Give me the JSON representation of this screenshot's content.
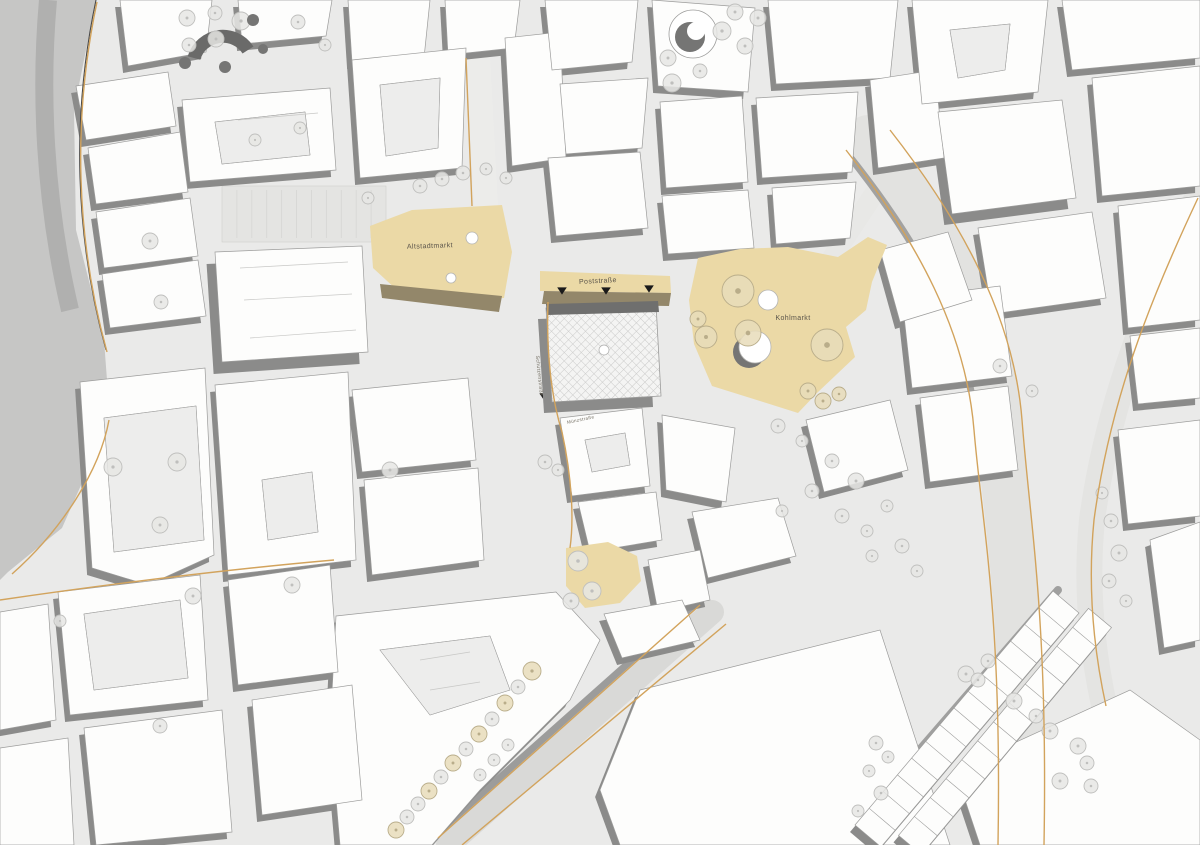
{
  "map": {
    "palette": {
      "street_bg": "#eaeae9",
      "road_band": "#c6c6c5",
      "road_band_inner": "#b0b0af",
      "building_fill": "#fdfdfc",
      "building_stroke": "#9c9c9b",
      "courtyard": "#ededec",
      "shadow": "#8b8b8a",
      "plaza_fill": "#ebd9a6",
      "plaza_band": "#93876a",
      "curb": "#d2a35c",
      "edge_dark": "#4a4a4a",
      "tree_light_fill": "#e6e6e4",
      "tree_light_stroke": "#bfbfbd",
      "tree_beige_fill": "#e8dcba",
      "tree_beige_stroke": "#b9ad8a",
      "tree_dark": "#757574",
      "hatch_bg": "#f4f4f3",
      "hatch_line": "#c9c9c8",
      "hatch_band": "#6f6f6e",
      "arrow": "#1a1a1a",
      "label": "#5a544a",
      "street_label": "#6f6a5e"
    },
    "labels": [
      {
        "text": "Altstadtmarkt",
        "x": 430,
        "y": 248,
        "size": 7,
        "rot": -2,
        "kind": "plaza"
      },
      {
        "text": "Poststraße",
        "x": 598,
        "y": 283,
        "size": 7,
        "rot": -3,
        "kind": "plaza"
      },
      {
        "text": "Kohlmarkt",
        "x": 793,
        "y": 320,
        "size": 7,
        "rot": 0,
        "kind": "plaza"
      },
      {
        "text": "Schützenstraße",
        "x": 538,
        "y": 376,
        "size": 5,
        "rot": 84,
        "kind": "street"
      },
      {
        "text": "Münzstraße",
        "x": 581,
        "y": 421,
        "size": 4.5,
        "rot": -12,
        "kind": "street"
      }
    ],
    "band": {
      "outline": "0,0 96,0 74,110 76,230 104,340 110,420 62,528 8,572 0,580",
      "inner": "M48,0 C40,90 44,200 70,310"
    },
    "roads": [
      {
        "d": "M486,206 L478,56",
        "c": "#ececea",
        "w": 24
      },
      {
        "d": "M832,258 L908,142",
        "c": "#e8e8e6",
        "w": 20
      },
      {
        "d": "M868,138 C940,230 990,320 998,420 C1006,520 1026,610 1022,845",
        "c": "#e2e2e0",
        "w": 46
      },
      {
        "d": "M846,152 C920,244 968,330 976,428",
        "c": "#a2a2a1",
        "w": 7
      },
      {
        "d": "M1198,196 C1150,300 1108,400 1092,520 C1086,580 1090,640 1104,705",
        "c": "#e4e4e2",
        "w": 26
      },
      {
        "d": "M712,612 L448,845",
        "c": "#d9d9d7",
        "w": 24
      },
      {
        "d": "M697,602 L434,836",
        "c": "#9c9c9b",
        "w": 7
      },
      {
        "d": "M850,830 L1058,590",
        "c": "#a0a09f",
        "w": 8
      }
    ],
    "curbs": [
      {
        "d": "M96,0 C71,118 75,238 106,350",
        "dark": true
      },
      {
        "d": "M97,2 C72,120 76,240 107,352"
      },
      {
        "d": "M109,420 C100,470 62,530 12,574"
      },
      {
        "d": "M700,605 L438,838"
      },
      {
        "d": "M726,624 L462,845"
      },
      {
        "d": "M846,150 C918,242 966,332 974,430 C982,525 1002,612 998,845"
      },
      {
        "d": "M890,130 C962,222 1014,318 1022,420 C1030,525 1048,615 1044,845"
      },
      {
        "d": "M1198,198 C1150,300 1110,400 1094,520 C1088,580 1092,642 1106,706"
      },
      {
        "d": "M548,302 C546,355 552,400 562,432 C572,478 574,520 570,548"
      },
      {
        "d": "M472,206 L466,58"
      },
      {
        "d": "M0,600 C110,584 220,570 334,560"
      }
    ],
    "parking": {
      "x": 222,
      "y": 186,
      "w": 164,
      "h": 56,
      "n": 11
    },
    "blocks": [
      {
        "pts": "120,0 212,0 206,52 128,66"
      },
      {
        "pts": "238,0 332,0 326,36 242,44"
      },
      {
        "pts": "348,0 430,0 424,58 352,62"
      },
      {
        "pts": "445,0 520,0 514,48 448,55"
      },
      {
        "pts": "76,86 168,72 176,126 86,140"
      },
      {
        "pts": "88,148 180,132 188,192 96,204"
      },
      {
        "pts": "96,212 190,198 198,256 104,268"
      },
      {
        "pts": "102,274 198,260 206,316 110,328"
      },
      {
        "pts": "182,100 330,88 336,170 190,182",
        "hole": "215,122 305,112 310,155 222,164"
      },
      {
        "pts": "215,252 362,246 368,352 222,362",
        "h": 12
      },
      {
        "pts": "352,60 466,48 462,168 360,178",
        "hole": "380,85 440,78 438,148 386,156"
      },
      {
        "pts": "505,38 560,32 566,158 512,166"
      },
      {
        "pts": "545,0 638,0 632,62 552,70"
      },
      {
        "pts": "652,0 755,8 748,92 658,86"
      },
      {
        "pts": "768,0 898,0 890,78 776,84"
      },
      {
        "pts": "560,84 648,78 642,148 566,154"
      },
      {
        "pts": "548,158 640,152 648,228 556,236"
      },
      {
        "pts": "660,102 742,96 748,182 666,188"
      },
      {
        "pts": "756,98 858,92 852,172 762,178"
      },
      {
        "pts": "662,196 748,190 754,248 668,254"
      },
      {
        "pts": "772,188 856,182 850,238 776,244"
      },
      {
        "pts": "870,80 935,70 944,158 878,168"
      },
      {
        "pts": "912,0 1048,0 1038,92 922,104",
        "hole": "950,30 1010,24 1005,70 958,78"
      },
      {
        "pts": "1062,0 1200,0 1200,58 1072,70"
      },
      {
        "pts": "938,112 1062,100 1076,198 952,214",
        "h": 11
      },
      {
        "pts": "1092,78 1200,66 1200,186 1102,196"
      },
      {
        "pts": "978,228 1092,212 1106,298 992,314"
      },
      {
        "pts": "1118,206 1200,196 1200,320 1128,328"
      },
      {
        "pts": "1130,336 1200,328 1200,398 1138,404"
      },
      {
        "pts": "902,298 1000,286 1012,376 912,388"
      },
      {
        "pts": "920,398 1008,386 1018,470 930,482"
      },
      {
        "pts": "1118,430 1200,420 1200,516 1128,524"
      },
      {
        "pts": "880,250 948,232 972,300 900,322"
      },
      {
        "pts": "806,420 890,400 908,470 824,492"
      },
      {
        "pts": "560,418 642,408 650,486 572,496",
        "hole": "585,440 625,433 630,465 592,472"
      },
      {
        "pts": "578,502 656,492 662,540 590,552"
      },
      {
        "pts": "662,415 735,428 726,502 666,490"
      },
      {
        "pts": "692,512 778,498 796,556 708,578"
      },
      {
        "pts": "648,560 700,550 710,600 658,612"
      },
      {
        "pts": "604,614 682,600 700,640 622,658"
      },
      {
        "pts": "336,616 556,592 600,640 570,700 480,790 432,845 340,845 330,730",
        "hole": "380,650 490,636 510,690 430,715"
      },
      {
        "pts": "640,690 880,630 950,845 620,845 600,790"
      },
      {
        "pts": "352,390 468,378 476,460 362,472"
      },
      {
        "pts": "364,480 478,468 484,560 372,575"
      },
      {
        "pts": "215,385 348,372 356,560 228,575",
        "hole": "262,480 312,472 318,532 268,540"
      },
      {
        "pts": "80,382 205,368 214,555 148,585 92,568",
        "hole": "104,418 196,406 204,540 114,552"
      },
      {
        "pts": "58,592 200,575 208,700 70,715",
        "hole": "84,614 180,600 188,678 94,690"
      },
      {
        "pts": "228,580 330,565 338,672 238,685"
      },
      {
        "pts": "84,728 222,710 232,832 96,845"
      },
      {
        "pts": "252,700 352,685 362,800 262,815"
      },
      {
        "pts": "0,612 48,604 56,720 0,730"
      },
      {
        "pts": "0,748 68,738 74,845 0,845"
      },
      {
        "pts": "955,770 1130,690 1200,740 1200,845 980,845"
      },
      {
        "pts": "1150,540 1200,522 1200,640 1164,648"
      }
    ],
    "row_strips": [
      {
        "x1": 868,
        "y1": 836,
        "x2": 1066,
        "y2": 602,
        "w": 34,
        "n": 14
      },
      {
        "x1": 910,
        "y1": 845,
        "x2": 1100,
        "y2": 618,
        "w": 30,
        "n": 12
      }
    ],
    "plazas": [
      {
        "name": "altstadtmarkt",
        "pts": "370,226 412,210 502,205 512,252 504,298 446,300 398,291 373,268"
      },
      {
        "name": "poststrasse",
        "pts": "540,271 670,276 671,293 540,291"
      },
      {
        "name": "kohlmarkt",
        "pts": "698,258 740,249 788,247 838,257 868,237 887,245 872,282 866,310 846,327 855,357 817,393 798,413 760,401 712,386 694,344 689,300"
      },
      {
        "name": "small-plaza",
        "pts": "566,548 608,542 637,556 641,581 620,603 585,608 566,586"
      }
    ],
    "plaza_bands": [
      {
        "pts": "380,284 502,296 499,312 382,298"
      },
      {
        "pts": "544,291 671,293 669,306 542,304"
      }
    ],
    "arrows": [
      [
        562,
        291,
        8
      ],
      [
        606,
        291,
        8
      ],
      [
        649,
        289,
        8
      ],
      [
        543,
        396,
        6
      ]
    ],
    "hatch_building": {
      "pts": "546,308 656,304 661,396 552,402",
      "band": "546,304 658,301 659,312 547,315",
      "atrium": [
        604,
        350,
        5
      ]
    },
    "features": {
      "fountain": {
        "dark": [
          749,
          352,
          16
        ],
        "white": [
          755,
          347,
          16
        ]
      },
      "rotunda": {
        "outer": [
          693,
          34,
          24
        ],
        "dark": [
          690,
          37,
          15
        ],
        "inner": [
          696,
          31,
          9
        ]
      },
      "park_arc": "M194,58 A30 30 0 0 1 248,50"
    },
    "detail_lines": [
      "M240,268 L348,262",
      "M244,300 L352,294",
      "M250,338 L356,330",
      "M420,660 L470,652",
      "M430,690 L480,682",
      "M238,120 L318,113"
    ],
    "trees": [
      [
        187,
        18,
        8,
        "L"
      ],
      [
        215,
        13,
        7,
        "L"
      ],
      [
        241,
        21,
        9,
        "L"
      ],
      [
        189,
        45,
        7,
        "L"
      ],
      [
        216,
        39,
        8,
        "L"
      ],
      [
        298,
        22,
        7,
        "L"
      ],
      [
        325,
        45,
        6,
        "L"
      ],
      [
        185,
        63,
        6,
        "D"
      ],
      [
        253,
        20,
        6,
        "D"
      ],
      [
        263,
        49,
        5,
        "D"
      ],
      [
        225,
        67,
        6,
        "D"
      ],
      [
        420,
        186,
        7,
        "L"
      ],
      [
        442,
        179,
        7,
        "L"
      ],
      [
        463,
        173,
        7,
        "L"
      ],
      [
        486,
        169,
        6,
        "L"
      ],
      [
        506,
        178,
        6,
        "L"
      ],
      [
        368,
        198,
        6,
        "L"
      ],
      [
        735,
        12,
        8,
        "L"
      ],
      [
        758,
        18,
        8,
        "L"
      ],
      [
        722,
        31,
        9,
        "L"
      ],
      [
        745,
        46,
        8,
        "L"
      ],
      [
        668,
        58,
        8,
        "L"
      ],
      [
        672,
        83,
        9,
        "L"
      ],
      [
        700,
        71,
        7,
        "L"
      ],
      [
        738,
        291,
        16,
        "B"
      ],
      [
        706,
        337,
        11,
        "B"
      ],
      [
        748,
        333,
        13,
        "B"
      ],
      [
        698,
        319,
        8,
        "B"
      ],
      [
        827,
        345,
        16,
        "B"
      ],
      [
        808,
        391,
        8,
        "B"
      ],
      [
        823,
        401,
        8,
        "B"
      ],
      [
        839,
        394,
        7,
        "B"
      ],
      [
        768,
        300,
        10,
        "W"
      ],
      [
        472,
        238,
        6,
        "W"
      ],
      [
        451,
        278,
        5,
        "W"
      ],
      [
        113,
        467,
        9,
        "L"
      ],
      [
        177,
        462,
        9,
        "L"
      ],
      [
        193,
        596,
        8,
        "L"
      ],
      [
        292,
        585,
        8,
        "L"
      ],
      [
        160,
        525,
        8,
        "L"
      ],
      [
        390,
        470,
        8,
        "L"
      ],
      [
        300,
        128,
        6,
        "L"
      ],
      [
        255,
        140,
        6,
        "L"
      ],
      [
        578,
        561,
        10,
        "L"
      ],
      [
        592,
        591,
        9,
        "L"
      ],
      [
        571,
        601,
        8,
        "L"
      ],
      [
        545,
        462,
        7,
        "L"
      ],
      [
        558,
        470,
        6,
        "L"
      ],
      [
        150,
        241,
        8,
        "L"
      ],
      [
        161,
        302,
        7,
        "L"
      ],
      [
        60,
        621,
        6,
        "L"
      ],
      [
        160,
        726,
        7,
        "L"
      ],
      [
        532,
        671,
        9,
        "B"
      ],
      [
        518,
        687,
        7,
        "L"
      ],
      [
        505,
        703,
        8,
        "B"
      ],
      [
        492,
        719,
        7,
        "L"
      ],
      [
        479,
        734,
        8,
        "B"
      ],
      [
        466,
        749,
        7,
        "L"
      ],
      [
        453,
        763,
        8,
        "B"
      ],
      [
        441,
        777,
        7,
        "L"
      ],
      [
        429,
        791,
        8,
        "B"
      ],
      [
        418,
        804,
        7,
        "L"
      ],
      [
        407,
        817,
        7,
        "L"
      ],
      [
        396,
        830,
        8,
        "B"
      ],
      [
        508,
        745,
        6,
        "L"
      ],
      [
        494,
        760,
        6,
        "L"
      ],
      [
        480,
        775,
        6,
        "L"
      ],
      [
        778,
        426,
        7,
        "L"
      ],
      [
        802,
        441,
        6,
        "L"
      ],
      [
        832,
        461,
        7,
        "L"
      ],
      [
        856,
        481,
        8,
        "L"
      ],
      [
        812,
        491,
        7,
        "L"
      ],
      [
        782,
        511,
        6,
        "L"
      ],
      [
        842,
        516,
        7,
        "L"
      ],
      [
        867,
        531,
        6,
        "L"
      ],
      [
        887,
        506,
        6,
        "L"
      ],
      [
        902,
        546,
        7,
        "L"
      ],
      [
        872,
        556,
        6,
        "L"
      ],
      [
        917,
        571,
        6,
        "L"
      ],
      [
        966,
        674,
        8,
        "L"
      ],
      [
        978,
        680,
        7,
        "L"
      ],
      [
        988,
        661,
        7,
        "L"
      ],
      [
        1014,
        701,
        8,
        "L"
      ],
      [
        1036,
        716,
        7,
        "L"
      ],
      [
        1050,
        731,
        8,
        "L"
      ],
      [
        1078,
        746,
        8,
        "L"
      ],
      [
        1087,
        763,
        7,
        "L"
      ],
      [
        1060,
        781,
        8,
        "L"
      ],
      [
        1091,
        786,
        7,
        "L"
      ],
      [
        876,
        743,
        7,
        "L"
      ],
      [
        888,
        757,
        6,
        "L"
      ],
      [
        869,
        771,
        6,
        "L"
      ],
      [
        881,
        793,
        7,
        "L"
      ],
      [
        858,
        811,
        6,
        "L"
      ],
      [
        1102,
        493,
        6,
        "L"
      ],
      [
        1111,
        521,
        7,
        "L"
      ],
      [
        1119,
        553,
        8,
        "L"
      ],
      [
        1109,
        581,
        7,
        "L"
      ],
      [
        1126,
        601,
        6,
        "L"
      ],
      [
        1000,
        366,
        7,
        "L"
      ],
      [
        1032,
        391,
        6,
        "L"
      ]
    ]
  }
}
